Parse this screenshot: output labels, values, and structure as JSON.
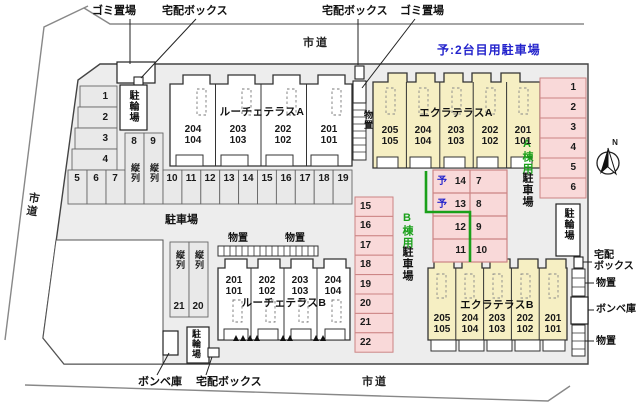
{
  "colors": {
    "site_fill": "#ededed",
    "cell_fill": "#e9e9e9",
    "pink_fill": "#f9d9d9",
    "pink_border": "#cc8484",
    "yellow_fill": "#f6efc3",
    "green_accent": "#1aa01a",
    "blue_accent": "#2323cc",
    "outline": "#444444"
  },
  "roads": {
    "label": "市道"
  },
  "notes": {
    "reserve": "予:2台目用駐車場"
  },
  "facilities": {
    "garbage": "ゴミ置場",
    "delivery_box": "宅配ボックス",
    "delivery_box_l1": "宅配",
    "delivery_box_l2": "ボックス",
    "bicycle": "駐輪場",
    "storage": "物置",
    "cylinder": "ボンベ庫",
    "parking": "駐車場",
    "tandem": "縦列"
  },
  "zones": {
    "a_green": "A棟用",
    "a_black": "駐車場",
    "b_green": "B棟用",
    "b_black": "駐車場"
  },
  "buildings": {
    "luce_a": {
      "name": "ルーチェテラスA",
      "units": [
        "204\n104",
        "203\n103",
        "202\n102",
        "201\n101"
      ]
    },
    "eclat_a": {
      "name": "エクラテラスA",
      "units": [
        "205\n105",
        "204\n104",
        "203\n103",
        "202\n102",
        "201\n101"
      ]
    },
    "luce_b": {
      "name": "ルーチェテラスB",
      "units": [
        "201\n101",
        "202\n102",
        "203\n103",
        "204\n104"
      ]
    },
    "eclat_b": {
      "name": "エクラテラスB",
      "units": [
        "205\n105",
        "204\n104",
        "203\n103",
        "202\n102",
        "201\n101"
      ]
    }
  },
  "parking": {
    "left_col": [
      "1",
      "2",
      "3",
      "4"
    ],
    "front_row": [
      "5",
      "6",
      "7"
    ],
    "tandem_top": [
      "8",
      "9"
    ],
    "main_row": [
      "10",
      "11",
      "12",
      "13",
      "14",
      "15",
      "16",
      "17",
      "18",
      "19"
    ],
    "b_col": [
      "15",
      "16",
      "17",
      "18",
      "19",
      "20",
      "21",
      "22"
    ],
    "a_col": [
      "1",
      "2",
      "3",
      "4",
      "5",
      "6"
    ],
    "tandem_bottom": [
      "21",
      "20"
    ],
    "table": [
      {
        "mark": "予",
        "num": "14",
        "pair": "7"
      },
      {
        "mark": "予",
        "num": "13",
        "pair": "8"
      },
      {
        "mark": "",
        "num": "12",
        "pair": "9"
      },
      {
        "mark": "",
        "num": "11",
        "pair": "10"
      }
    ]
  },
  "compass": {
    "n": "N"
  }
}
